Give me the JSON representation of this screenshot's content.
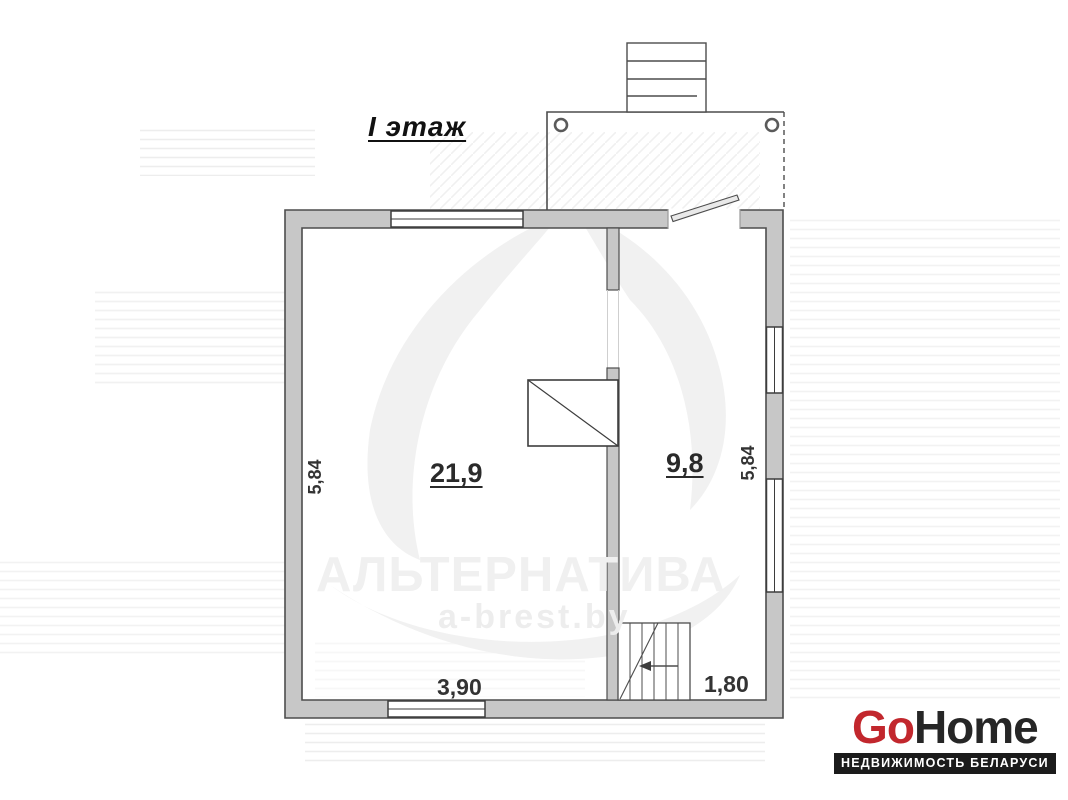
{
  "floorplan": {
    "title": "I этаж",
    "room_large": {
      "area": "21,9"
    },
    "room_small": {
      "area": "9,8"
    },
    "dimensions": {
      "left": "5,84",
      "right": "5,84",
      "bottom_left": "3,90",
      "bottom_right": "1,80"
    },
    "colors": {
      "wall_fill": "#c7c7c7",
      "wall_stroke": "#4d4d4d"
    }
  },
  "watermark": {
    "brand": "АЛЬТЕРНАТИВА",
    "website": "a-brest.by"
  },
  "branding": {
    "logo_go": "Go",
    "logo_home": "Home",
    "tagline": "НЕДВИЖИМОСТЬ БЕЛАРУСИ",
    "logo_red": "#c2272d",
    "logo_dark": "#262626",
    "bar_bg": "#1b1b1b"
  }
}
